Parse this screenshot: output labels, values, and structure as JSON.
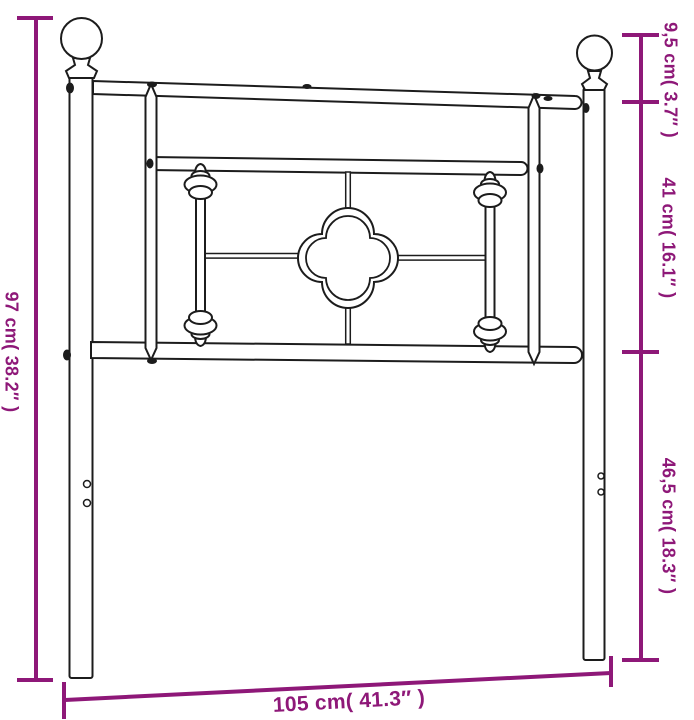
{
  "page": {
    "background": "#ffffff",
    "kind": "product dimension line drawing",
    "depicts": "metal headboard with ball finials, spindles and quatrefoil ornament"
  },
  "colors": {
    "dimension_accent": "#8E1878",
    "line_art": "#1c1c1c"
  },
  "dimension_labels": {
    "left": "97 cm( 38.2″ )",
    "right_top": "9,5 cm( 3.7″ )",
    "right_middle": "41 cm( 16.1″ )",
    "right_bottom": "46,5 cm( 18.3″ )",
    "bottom": "105 cm( 41.3″ )"
  },
  "measurements": [
    {
      "position": "left",
      "cm": "97",
      "inches": "38.2"
    },
    {
      "position": "right-top",
      "cm": "9,5",
      "inches": "3.7"
    },
    {
      "position": "right-middle",
      "cm": "41",
      "inches": "16.1"
    },
    {
      "position": "right-bottom",
      "cm": "46,5",
      "inches": "18.3"
    },
    {
      "position": "bottom",
      "cm": "105",
      "inches": "41.3"
    }
  ]
}
